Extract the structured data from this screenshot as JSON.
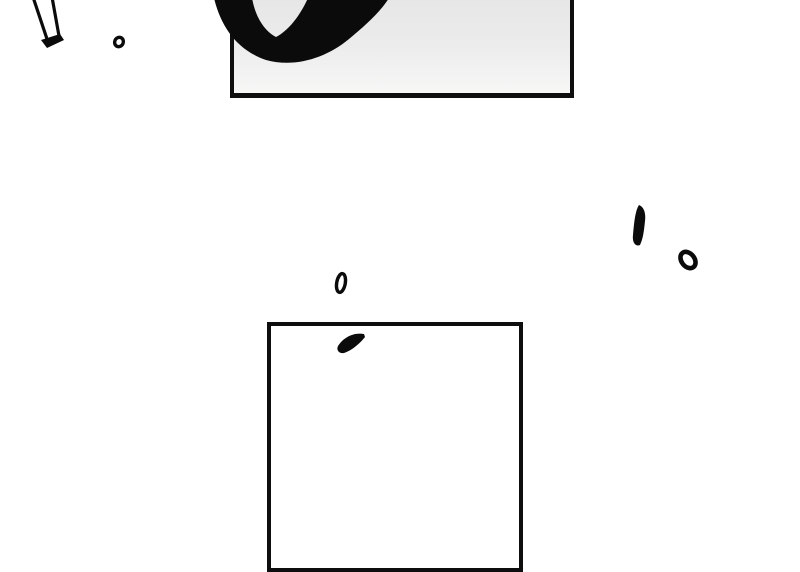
{
  "scene": {
    "kind": "comic-page-fragment",
    "text_content": ""
  },
  "colors": {
    "background": "#ffffff",
    "ink": "#0b0b0b",
    "panel_border": "#0e0e0e",
    "panel_top_fill_start": "#e5e5e5",
    "panel_top_fill_end": "#f7f7f6",
    "panel_bottom_fill": "#ffffff"
  },
  "marks": {
    "sfx_brush_stroke": "bottom arc of a large hand-brushed oval glyph, clipped by top edge",
    "speed_line": "hollow slanted double-line stroke with solid cap, top-left",
    "small_ring_1": "small hollow ink ring, top-left",
    "exclamation_dash": "solid tapered vertical dash, middle-right",
    "small_ring_2": "slanted hollow ink ring, middle-right",
    "small_oval": "small hollow oval above bottom panel",
    "brush_flick": "solid slanted flick stroke inside bottom panel"
  }
}
